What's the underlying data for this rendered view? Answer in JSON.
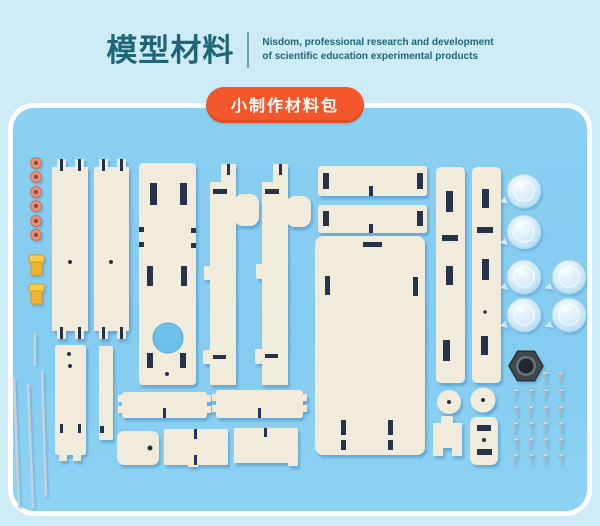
{
  "header": {
    "title": "模型材料",
    "tagline_line1": "Nisdom, professional research and development",
    "tagline_line2": "of scientific education experimental products"
  },
  "badge": {
    "label": "小制作材料包"
  },
  "contents": {
    "wooden_pieces": 21,
    "pink_spacers": 6,
    "yellow_clips": 2,
    "metal_rods": 4,
    "suction_cups": 6,
    "hex_nuts": 1,
    "screws": 22
  },
  "colors": {
    "background": "#cdecf7",
    "panel_blue": "#84cbf0",
    "panel_border": "#ffffff",
    "badge_orange": "#f4572b",
    "title_teal": "#1e6577",
    "wood": "#f1ebdb",
    "slot_dark": "#27324a",
    "ring_pink": "#e9917b",
    "clip_yellow": "#f1b32e",
    "rod_gray": "#c7d1d9",
    "nut_dark": "#40464e",
    "screw_gray": "#aeb6c0"
  }
}
